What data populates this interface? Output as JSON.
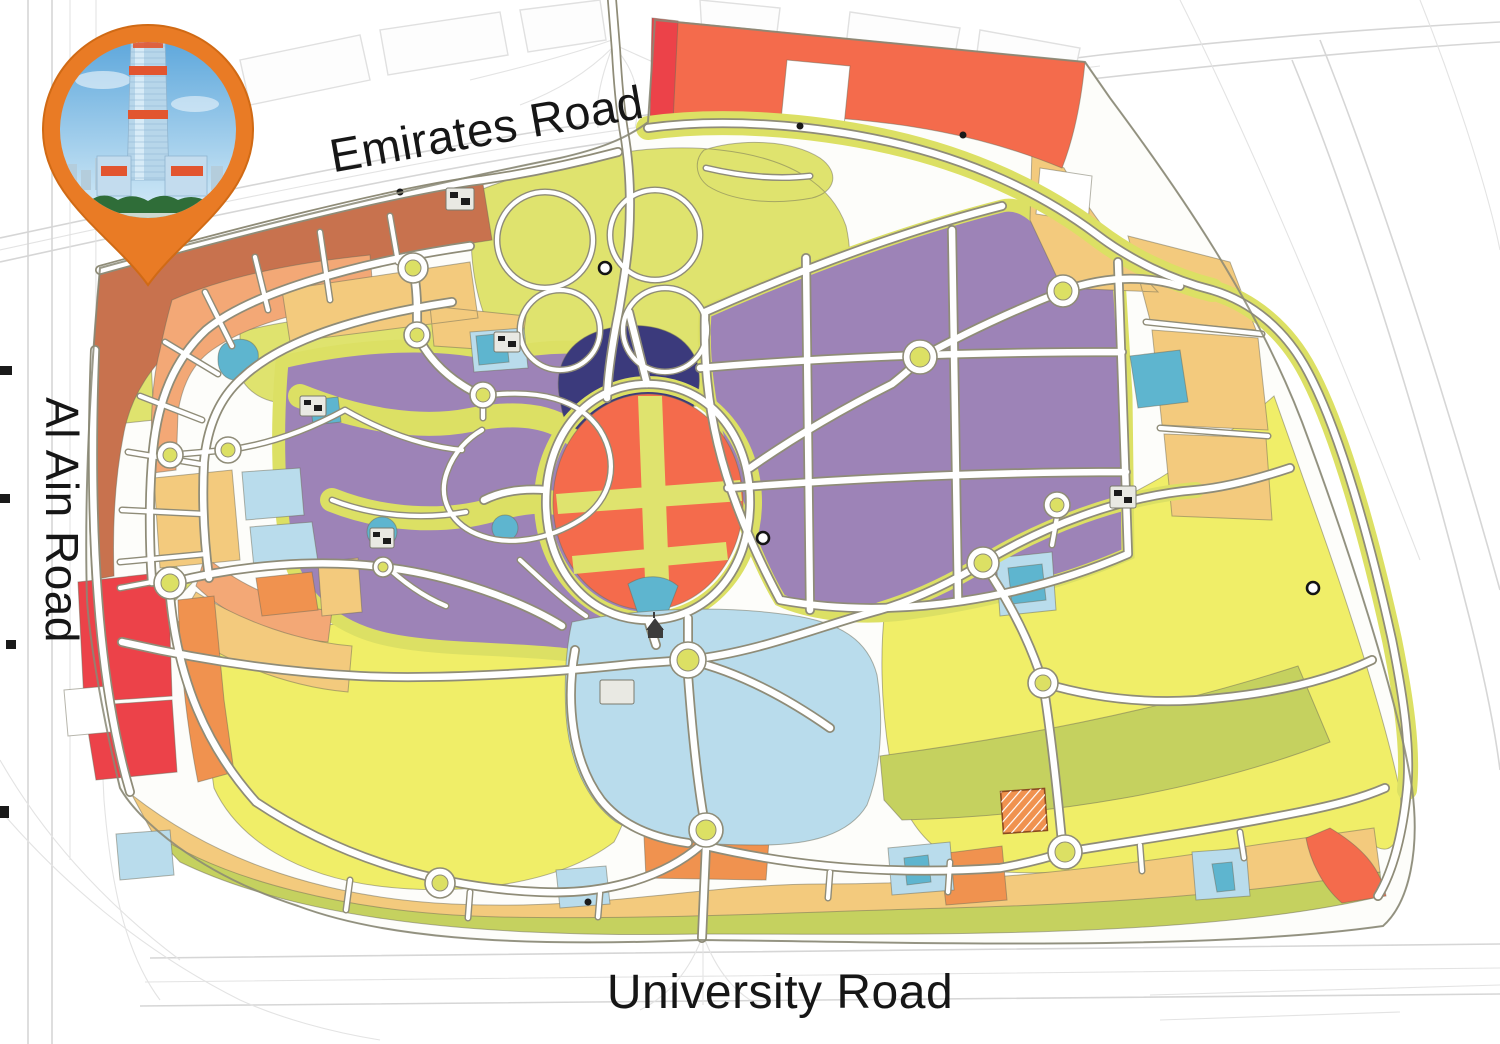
{
  "map": {
    "roads": {
      "top": "Emirates Road",
      "left": "Al Ain Road",
      "bottom": "University Road"
    },
    "marker": {
      "alt": "high-rise tower photo location pin"
    },
    "palette": {
      "terracotta": "#c8724e",
      "peach": "#f3a876",
      "salmon": "#f46b4c",
      "orange": "#f0924f",
      "gold": "#f3ca7d",
      "yellow": "#f0ee68",
      "lime": "#dfe36e",
      "olive": "#c5d15f",
      "purple": "#9d83b7",
      "navy": "#3b3a7c",
      "sky": "#b9dcec",
      "teal": "#5eb5cf",
      "red": "#ec4249",
      "white": "#ffffff",
      "site_base": "#fdfdfa",
      "pin_orange": "#e97b25",
      "casing": "#8f8c78",
      "road": "#ffffff",
      "label": "#161616"
    }
  }
}
